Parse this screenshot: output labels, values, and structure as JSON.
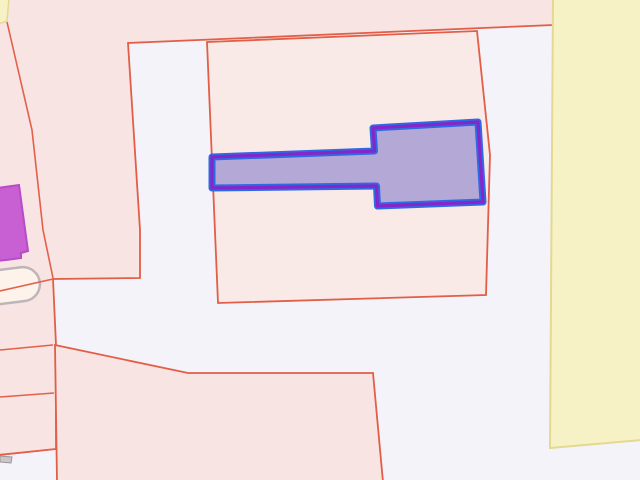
{
  "map": {
    "canvas": {
      "width": 640,
      "height": 480,
      "background": "#f4f3f9"
    },
    "palette": {
      "parcel_stroke": "#e25e46",
      "parcel_fill": "#f8e4e2",
      "parcel_fill_light": "#f9eae7",
      "zone_yellow_fill": "#f6f2c6",
      "zone_yellow_stroke": "#e4d98c",
      "selection_halo_blue": "#2e6ae4",
      "selection_core_purple": "#8526c9",
      "selection_fill": "#b3a8d6",
      "building_magenta_fill": "#c85fd2",
      "building_magenta_stroke": "#b84cc6",
      "tank_fill": "#fdf3ea",
      "tank_stroke": "#beb5bc",
      "small_building_gray": "#c9c5c9"
    },
    "shapes": [
      {
        "name": "parcel-top-left",
        "points": "-2,-2 553,-2 553,25 128,43 140,230 140,278 53,279 56,345 56,395 56,449 -2,455",
        "fill": "#f8e4e2",
        "stroke": "#e25e46",
        "sw": 1.8
      },
      {
        "name": "parcel-central",
        "points": "207,42 477,31 490,155 486,295 218,303",
        "fill": "#f9eae7",
        "stroke": "#e25e46",
        "sw": 1.8
      },
      {
        "name": "parcel-bottom",
        "points": "55,345 188,373 373,373 383,482 57,482",
        "fill": "#f8e4e2",
        "stroke": "#e25e46",
        "sw": 1.8
      },
      {
        "name": "zone-yellow-right",
        "points": "553,-2 642,-2 642,440 550,448",
        "fill": "#f6f2c6",
        "stroke": "#e4d98c",
        "sw": 2
      },
      {
        "name": "zone-yellow-corner",
        "points": "-2,-2 9,-2 7,21 -2,24",
        "fill": "#f6f2c6",
        "stroke": "#e4d98c",
        "sw": 1.5
      },
      {
        "name": "building-magenta",
        "points": "-3,188 19,185 28,251 21,253 21,258 6,260 -3,261",
        "fill": "#c85fd2",
        "stroke": "#b84cc6",
        "sw": 2
      },
      {
        "name": "building-gray-small",
        "points": "0,456 12,457 11,463 0,462",
        "fill": "#c9c5c9",
        "stroke": "#9b979b",
        "sw": 1
      }
    ],
    "boundary_lines": {
      "stroke": "#e4604a",
      "sw": 1.6,
      "items": [
        {
          "name": "boundary-diagonal-left",
          "points": "7,22 32,130 43,230 53,278"
        },
        {
          "name": "boundary-left-upper",
          "points": "0,291 53,279"
        },
        {
          "name": "boundary-left-mid",
          "points": "0,350 53,345"
        },
        {
          "name": "boundary-left-lower",
          "points": "0,397 54,393"
        },
        {
          "name": "boundary-left-bottom",
          "points": "0,455 56,449"
        }
      ]
    },
    "tank": {
      "x": -24,
      "y": 269,
      "width": 64,
      "height": 34,
      "rx": 17,
      "transform": "rotate(-7 8 286)",
      "fill": "#fdf3ea",
      "stroke": "#beb5bc",
      "sw": 2.5
    },
    "highlighted_building": {
      "points": "212,157 374.5,151 373,128 478,122 483,202 377.5,206 376.5,186 212,188",
      "fill": "#b3a8d6",
      "halo_stroke": "#2e6ae4",
      "halo_sw": 7,
      "core_stroke": "#8526c9",
      "core_sw": 3.2
    }
  }
}
